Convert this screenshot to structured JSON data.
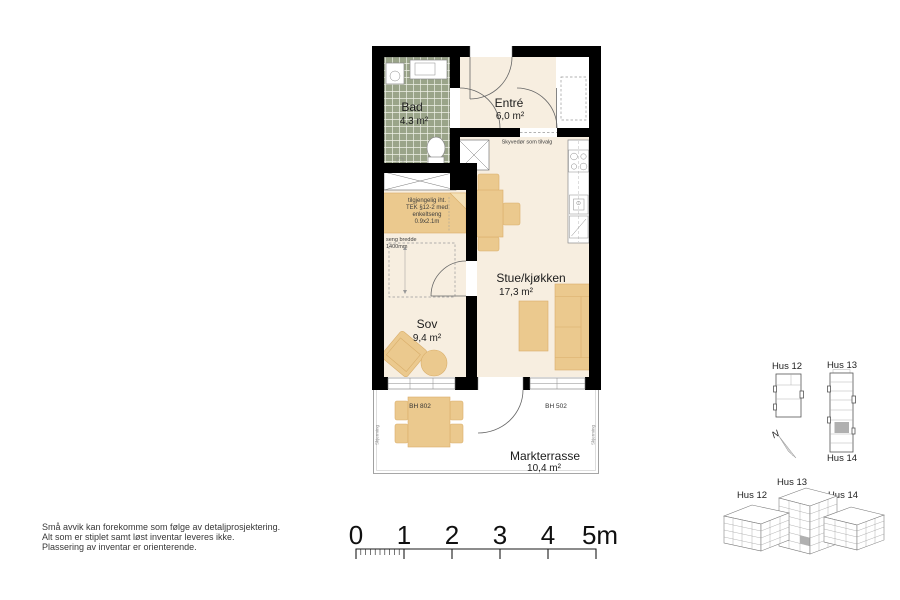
{
  "rooms": {
    "bad": {
      "name": "Bad",
      "area": "4,3 m²"
    },
    "entre": {
      "name": "Entré",
      "area": "6,0 m²"
    },
    "stue": {
      "name": "Stue/kjøkken",
      "area": "17,3 m²"
    },
    "sov": {
      "name": "Sov",
      "area": "9,4 m²"
    },
    "terrasse": {
      "name": "Markterrasse",
      "area": "10,4 m²"
    }
  },
  "annotations": {
    "sliding_door": "Skyvedør som tilvalg",
    "bed_note_l1": "tilgjengelig iht.",
    "bed_note_l2": "TEK §12-2 med",
    "bed_note_l3": "enkeltseng",
    "bed_note_l4": "0.9x2.1m",
    "bed_width_l1": "seng bredde",
    "bed_width_l2": "1400mm",
    "window_sov": "BH 802",
    "window_stue": "BH 502",
    "screen_left": "Skjerming",
    "screen_right": "Skjerming"
  },
  "key_plan": {
    "hus12": "Hus 12",
    "hus13": "Hus 13",
    "hus14": "Hus 14",
    "north": "N"
  },
  "iso_view": {
    "hus12": "Hus 12",
    "hus13": "Hus 13",
    "hus14": "Hus 14"
  },
  "notes": {
    "line1": "Små avvik kan forekomme som følge av detaljprosjektering.",
    "line2": "Alt som er stiplet samt løst inventar leveres ikke.",
    "line3": "Plassering av inventar er orienterende."
  },
  "scale_bar": {
    "labels": [
      "0",
      "1",
      "2",
      "3",
      "4",
      "5m"
    ]
  },
  "colors": {
    "wall": "#000000",
    "floor": "#f7eee0",
    "furniture": "#ebc98e",
    "bath_tile": "#9aa489",
    "highlight_unit": "#b0b0b0"
  }
}
